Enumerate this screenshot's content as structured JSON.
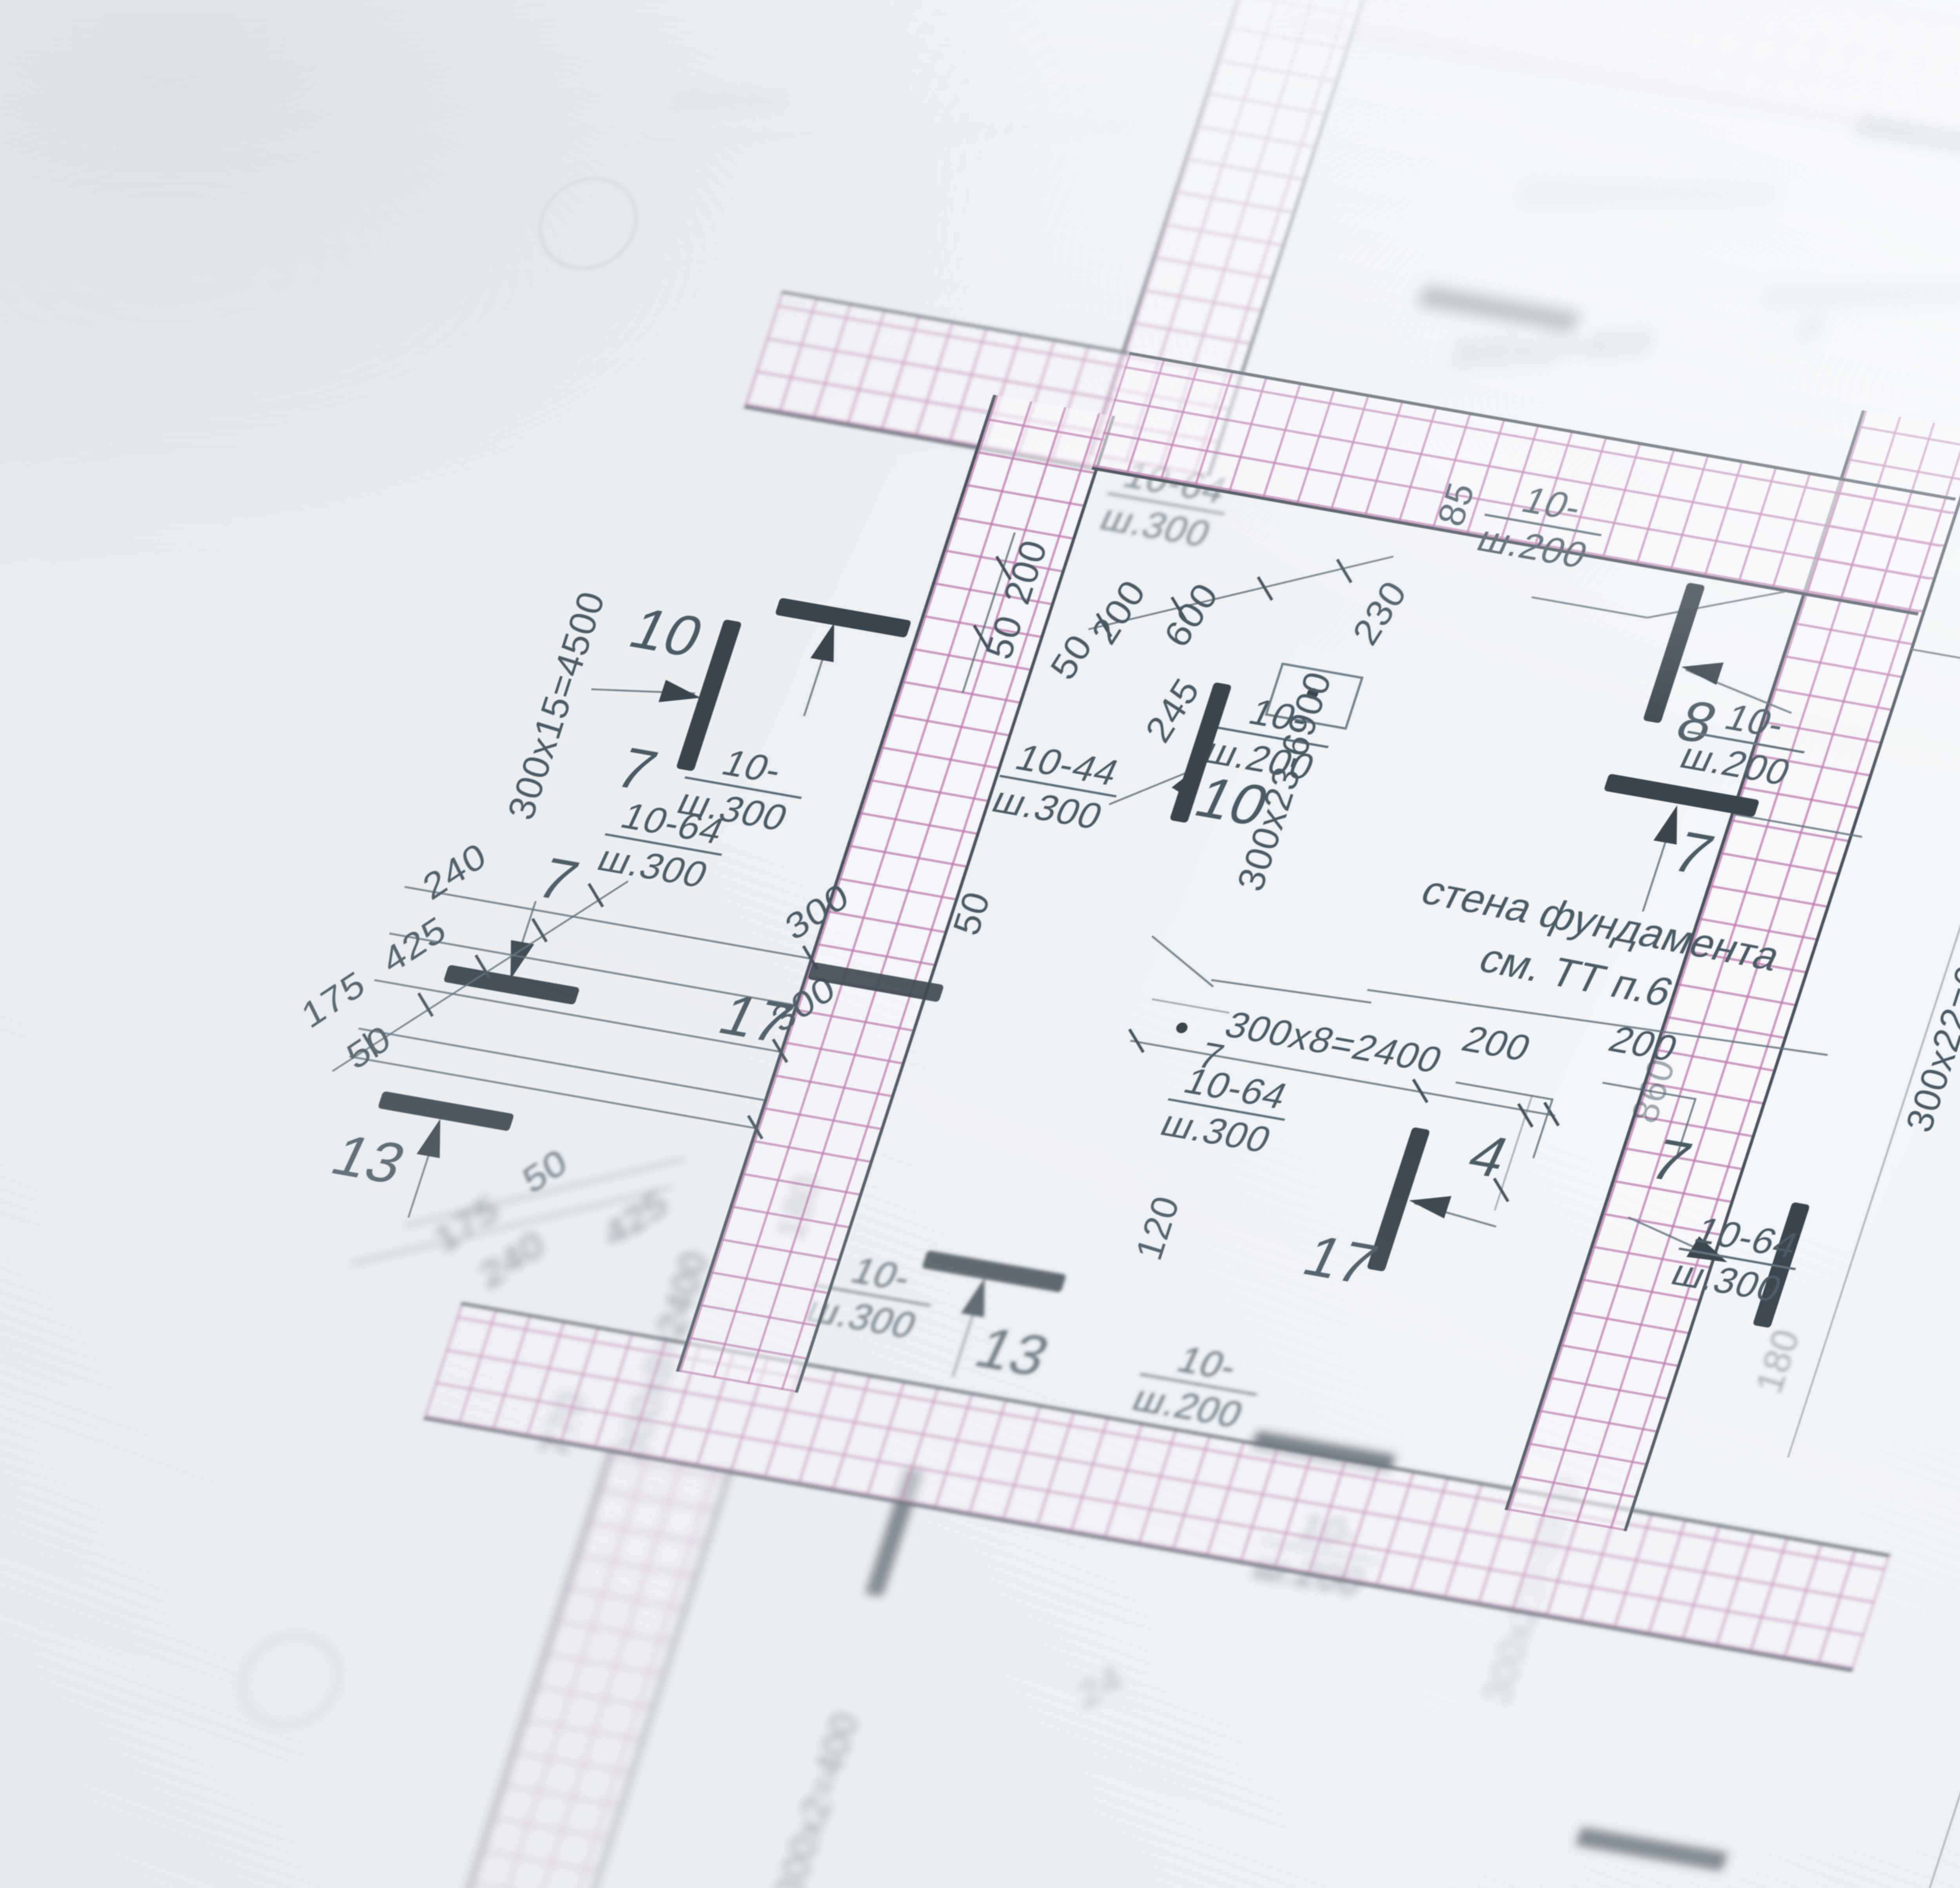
{
  "scene": {
    "description": "close-up photo of a foundation reinforcement plan blueprint",
    "colors": {
      "paper": "#eef1f3",
      "hatch_pink": "#c17bb1",
      "line_gray": "#5f707b",
      "bar_dark": "#39444d",
      "text": "#4b5b66"
    }
  },
  "note": {
    "line1": "\u0441\u0442\u0435\u043d\u0430 \u0444\u0443\u043d\u0434\u0430\u043c\u0435\u043d\u0442\u0430",
    "line2": "\u0441\u043c. \u0422\u0422 \u043f.6"
  },
  "grid": {
    "bubble_b": "\u0412"
  },
  "marks": {
    "m8": "8",
    "m8t": "8",
    "m7c": "7",
    "m10l": "10",
    "m7l": "7",
    "m7l2": "7",
    "m10c": "10",
    "m17l": "17",
    "m17m": "17",
    "m4": "4",
    "m7m": "7",
    "m7s": "7",
    "m7r": "7",
    "m15": "15",
    "m13l": "13",
    "m13b": "13"
  },
  "frac": {
    "f1": {
      "t": "10-",
      "b": "\u0448.200"
    },
    "f2": {
      "t": "10-",
      "b": "\u0448.200"
    },
    "f3": {
      "t": "10-",
      "b": "\u0448.200"
    },
    "f4": {
      "t": "10-64",
      "b": "\u0448.300"
    },
    "f5": {
      "t": "10-",
      "b": "\u0448.300"
    },
    "f6": {
      "t": "10-64",
      "b": "\u0448.300"
    },
    "f7": {
      "t": "10-44",
      "b": "\u0448.300"
    },
    "f8": {
      "t": "10-64",
      "b": "\u0448.300"
    },
    "f9": {
      "t": "10-64",
      "b": "\u0448.300"
    },
    "f10": {
      "t": "10-64",
      "b": "\u0448.300"
    },
    "f11": {
      "t": "10-",
      "b": "\u0448.300"
    },
    "f12": {
      "t": "10-",
      "b": "\u0448.200"
    },
    "f13": {
      "t": "10-",
      "b": "\u0448.200"
    }
  },
  "dims": {
    "d240": "240",
    "d425": "425",
    "d175": "175",
    "d50": "50",
    "d200a": "200",
    "d50a": "50",
    "d300a": "300",
    "d50b": "50",
    "d300b": "300",
    "d50u": "50",
    "d200u": "200",
    "d600": "600",
    "d245": "245",
    "d230": "230",
    "d85": "85",
    "d200m": "200",
    "d200n": "200",
    "d860": "860",
    "d120": "120",
    "d175r": "175",
    "d300r": "300",
    "d50r": "50",
    "d75": "75",
    "d250": "250",
    "d300s": "300",
    "d7080": "7080",
    "d6175": "6175",
    "d3600": "3600",
    "d180": "180",
    "d50L": "50",
    "d175L": "175",
    "d240L": "240",
    "d425L": "425",
    "d180L": "180",
    "d770": "770",
    "d24": "24"
  },
  "runs": {
    "r4500": "300\u044515=4500",
    "r6900": "300\u044523-6900",
    "r2400": "300\u04458=2400",
    "r6600": "300\u044522=6600",
    "r2400b": "300\u04458=2400",
    "r400t": "300\u04452=400",
    "r400b": "300\u04452=400",
    "r6900b": "300\u044523=6900"
  }
}
